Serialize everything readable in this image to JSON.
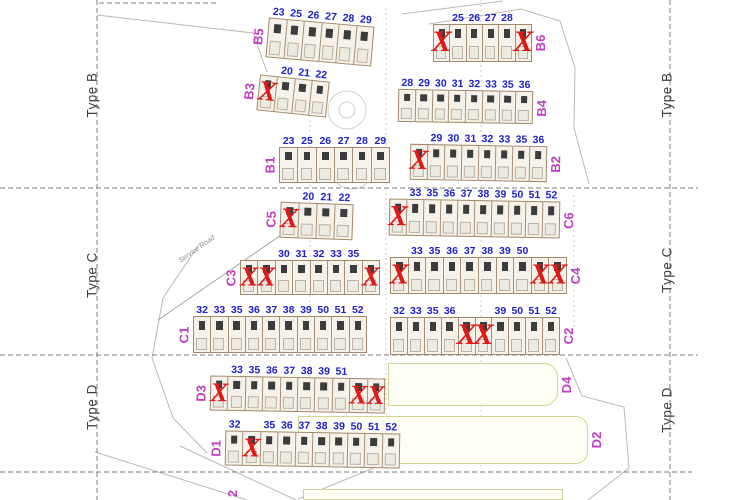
{
  "road": {
    "label": "Service Road"
  },
  "partial_label": {
    "text": "2"
  },
  "colors": {
    "unit_number": "#2020cc",
    "sold_x": "#e01818",
    "block_label": "#c13ec1",
    "zone_label": "#3f3f3f",
    "building_border": "#a18a6b",
    "building_fill": "#f6f2e9",
    "yellow_border": "#d0d593",
    "yellow_fill": "#fffef4"
  },
  "zone_labels": [
    {
      "text": "Type B",
      "x": 92,
      "y": 95,
      "side": "left"
    },
    {
      "text": "Type C",
      "x": 92,
      "y": 275,
      "side": "left"
    },
    {
      "text": "Type D",
      "x": 92,
      "y": 407,
      "side": "left"
    },
    {
      "text": "Type B",
      "x": 667,
      "y": 95,
      "side": "right"
    },
    {
      "text": "Type C",
      "x": 667,
      "y": 270,
      "side": "right"
    },
    {
      "text": "Type D",
      "x": 667,
      "y": 410,
      "side": "right"
    }
  ],
  "blocks": [
    {
      "label": "B5",
      "label_side": "left",
      "x": 267,
      "y": 22,
      "w": 106,
      "h": 40,
      "rot": 5,
      "cells": [
        "23",
        "25",
        "26",
        "27",
        "28",
        "29"
      ]
    },
    {
      "label": "B6",
      "label_side": "right",
      "x": 433,
      "y": 24,
      "w": 99,
      "h": 38,
      "rot": 0,
      "cells": [
        "X",
        "25",
        "26",
        "27",
        "28",
        "X"
      ]
    },
    {
      "label": "B3",
      "label_side": "left",
      "x": 258,
      "y": 78,
      "w": 70,
      "h": 36,
      "rot": 6,
      "cells": [
        "X",
        "20",
        "21",
        "22"
      ]
    },
    {
      "label": "B4",
      "label_side": "right",
      "x": 398,
      "y": 90,
      "w": 135,
      "h": 33,
      "rot": 1,
      "cells": [
        "28",
        "29",
        "30",
        "31",
        "32",
        "33",
        "35",
        "36"
      ]
    },
    {
      "label": "B1",
      "label_side": "left",
      "x": 279,
      "y": 147,
      "w": 111,
      "h": 36,
      "rot": 0,
      "cells": [
        "23",
        "25",
        "26",
        "27",
        "28",
        "29"
      ]
    },
    {
      "label": "B2",
      "label_side": "right",
      "x": 410,
      "y": 145,
      "w": 137,
      "h": 36,
      "rot": 1,
      "cells": [
        "X",
        "29",
        "30",
        "31",
        "32",
        "33",
        "35",
        "36"
      ]
    },
    {
      "label": "C5",
      "label_side": "left",
      "x": 280,
      "y": 203,
      "w": 73,
      "h": 36,
      "rot": 2,
      "cells": [
        "X",
        "20",
        "21",
        "22"
      ]
    },
    {
      "label": "C6",
      "label_side": "right",
      "x": 389,
      "y": 200,
      "w": 171,
      "h": 37,
      "rot": 1,
      "cells": [
        "X",
        "33",
        "35",
        "36",
        "37",
        "38",
        "39",
        "50",
        "51",
        "52"
      ]
    },
    {
      "label": "C3",
      "label_side": "left",
      "x": 240,
      "y": 260,
      "w": 140,
      "h": 35,
      "rot": 0,
      "cells": [
        "X",
        "X",
        "30",
        "31",
        "32",
        "33",
        "35",
        "X"
      ]
    },
    {
      "label": "C4",
      "label_side": "right",
      "x": 390,
      "y": 257,
      "w": 177,
      "h": 37,
      "rot": 0,
      "cells": [
        "X",
        "33",
        "35",
        "36",
        "37",
        "38",
        "39",
        "50",
        "X",
        "X"
      ]
    },
    {
      "label": "C1",
      "label_side": "left",
      "x": 193,
      "y": 316,
      "w": 174,
      "h": 37,
      "rot": 0,
      "cells": [
        "32",
        "33",
        "35",
        "36",
        "37",
        "38",
        "39",
        "50",
        "51",
        "52"
      ]
    },
    {
      "label": "C2",
      "label_side": "right",
      "x": 390,
      "y": 317,
      "w": 170,
      "h": 38,
      "rot": 0,
      "cells": [
        "32",
        "33",
        "35",
        "36",
        "X",
        "X",
        "39",
        "50",
        "51",
        "52"
      ]
    },
    {
      "label": "D3",
      "label_side": "left",
      "x": 210,
      "y": 377,
      "w": 175,
      "h": 35,
      "rot": 1,
      "cells": [
        "X",
        "33",
        "35",
        "36",
        "37",
        "38",
        "39",
        "51",
        "X",
        "X"
      ]
    },
    {
      "label": "D1",
      "label_side": "left",
      "x": 225,
      "y": 432,
      "w": 175,
      "h": 35,
      "rot": 1,
      "cells": [
        "32",
        "X",
        "35",
        "36",
        "37",
        "38",
        "39",
        "50",
        "51",
        "52"
      ]
    }
  ],
  "yellow_blocks": [
    {
      "label": "D4",
      "x": 388,
      "y": 363,
      "w": 170,
      "h": 43,
      "radius": 14
    },
    {
      "label": "D2",
      "x": 298,
      "y": 416,
      "w": 290,
      "h": 48,
      "radius": 12
    },
    {
      "label": "",
      "x": 303,
      "y": 489,
      "w": 260,
      "h": 11,
      "radius": 0
    }
  ]
}
